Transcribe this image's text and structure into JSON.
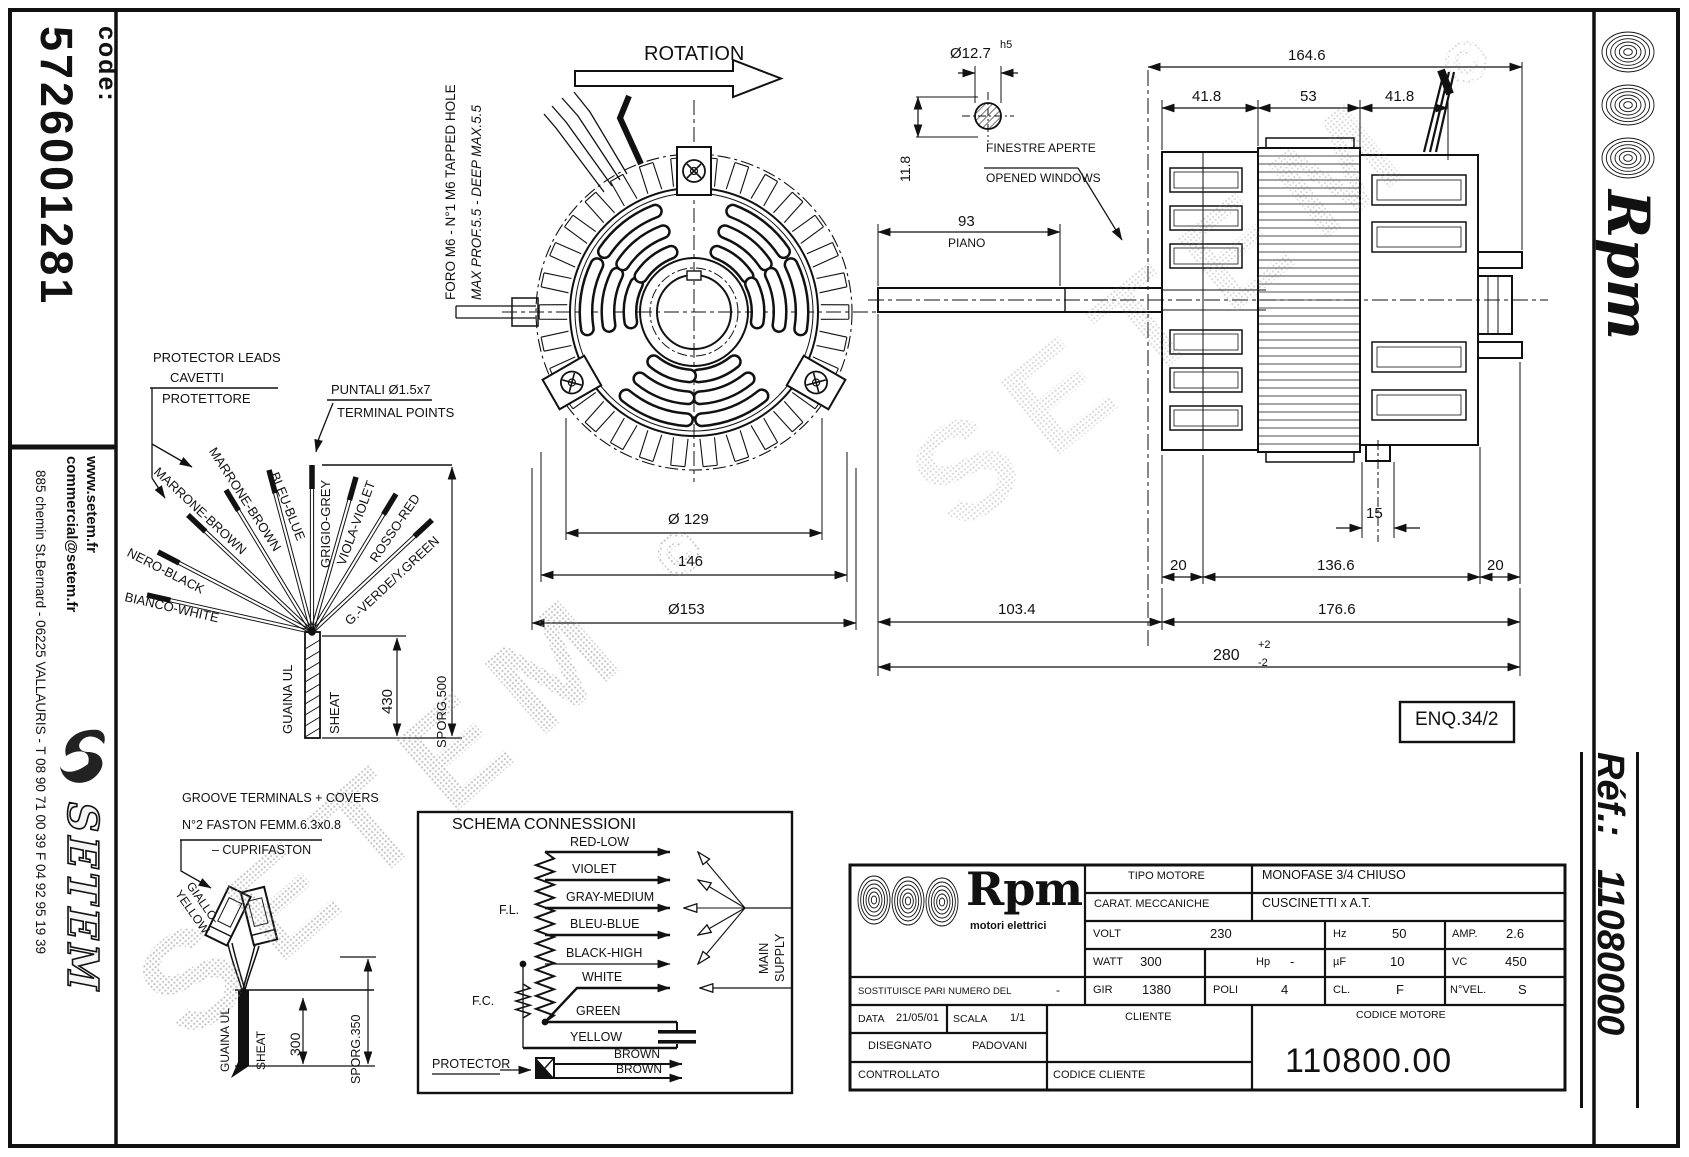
{
  "left_strip": {
    "code_label": "code:",
    "code_value": "5726001281",
    "website": "www.setem.fr",
    "email": "commercial@setem.fr",
    "address": "885 chemin St.Bernard  -  06225 VALLAURIS  -  T 08 90 71 00 39  F 04 92 95 19 39",
    "brand_mark": "S",
    "brand": "SETEM"
  },
  "right_strip": {
    "brand": "Rpm",
    "ref_label": "Réf.:",
    "ref_value": "11080000"
  },
  "watermark": {
    "text": "SETEM",
    "mark": "©"
  },
  "front_view": {
    "rotation_label": "ROTATION",
    "tapped_hole_note_line1": "FORO M6 - N°1 M6 TAPPED HOLE",
    "tapped_hole_note_line2": "MAX PROF.5.5 - DEEP MAX.5.5",
    "dim_rotor": "Ø 129",
    "dim_mid": "146",
    "dim_outer": "Ø153"
  },
  "leads": {
    "protector_en": "PROTECTOR LEADS",
    "protector_it1": "CAVETTI",
    "protector_it2": "PROTETTORE",
    "terminal_it": "PUNTALI Ø1.5x7",
    "terminal_en": "TERMINAL POINTS",
    "wires": [
      "BIANCO-WHITE",
      "NERO-BLACK",
      "MARRONE-BROWN",
      "MARRONE-BROWN",
      "BLEU-BLUE",
      "GRIGIO-GREY",
      "VIOLA-VIOLET",
      "ROSSO-RED",
      "G.-VERDE/Y.GREEN"
    ],
    "sheath_it": "GUAINA UL",
    "sheath_en": "SHEAT",
    "dim_length": "430",
    "dim_sporg": "SPORG.500"
  },
  "side_view": {
    "windows_it": "FINESTRE APERTE",
    "windows_en": "OPENED WINDOWS",
    "plain_label": "PIANO",
    "enq": "ENQ.34/2",
    "dims": {
      "shaft_dia": "Ø12.7",
      "shaft_tol": "h5",
      "key": "11.8",
      "plain": "93",
      "total": "164.6",
      "seg_a": "41.8",
      "seg_b": "53",
      "seg_c": "41.8",
      "hub": "15",
      "end_a": "20",
      "core": "136.6",
      "end_b": "20",
      "shaft_len": "103.4",
      "body": "176.6",
      "overall": "280",
      "tol_plus": "+2",
      "tol_minus": "-2"
    }
  },
  "groove": {
    "title": "GROOVE TERMINALS + COVERS",
    "faston": "N°2 FASTON FEMM.6.3x0.8",
    "cuprifaston": "– CUPRIFASTON",
    "wire_label_1": "GIALLO-",
    "wire_label_2": "YELLOW",
    "sheath_it": "GUAINA UL",
    "sheath_en": "SHEAT",
    "dim_length": "300",
    "dim_sporg": "SPORG.350"
  },
  "schema": {
    "title": "SCHEMA CONNESSIONI",
    "taps": [
      "RED-LOW",
      "VIOLET",
      "GRAY-MEDIUM",
      "BLEU-BLUE",
      "BLACK-HIGH",
      "WHITE",
      "GREEN",
      "YELLOW"
    ],
    "fl": "F.L.",
    "fc": "F.C.",
    "main_line1": "MAIN",
    "main_line2": "SUPPLY",
    "protector": "PROTECTOR",
    "brown_top": "BROWN",
    "brown_bottom": "BROWN"
  },
  "title_block": {
    "brand": "Rpm",
    "brand_sub": "motori elettrici",
    "tipo_label": "TIPO MOTORE",
    "tipo_value": "MONOFASE 3/4 CHIUSO",
    "carat_label": "CARAT. MECCANICHE",
    "carat_value": "CUSCINETTI x A.T.",
    "volt_label": "VOLT",
    "volt": "230",
    "hz_label": "Hz",
    "hz": "50",
    "amp_label": "AMP.",
    "amp": "2.6",
    "watt_label": "WATT",
    "watt": "300",
    "hp_label": "Hp",
    "hp": "-",
    "uf_label": "µF",
    "uf": "10",
    "vc_label": "VC",
    "vc": "450",
    "gir_label": "GIR",
    "gir": "1380",
    "poli_label": "POLI",
    "poli": "4",
    "cl_label": "CL.",
    "cl": "F",
    "nvel_label": "N°VEL.",
    "nvel": "S",
    "sost_label": "SOSTITUISCE PARI NUMERO DEL",
    "sost_value": "-",
    "data_label": "DATA",
    "data_value": "21/05/01",
    "scala_label": "SCALA",
    "scala_value": "1/1",
    "cliente_label": "CLIENTE",
    "codice_motore_label": "CODICE MOTORE",
    "codice_motore": "110800.00",
    "disegnato_label": "DISEGNATO",
    "disegnato": "PADOVANI",
    "controllato_label": "CONTROLLATO",
    "codice_cliente_label": "CODICE CLIENTE"
  }
}
